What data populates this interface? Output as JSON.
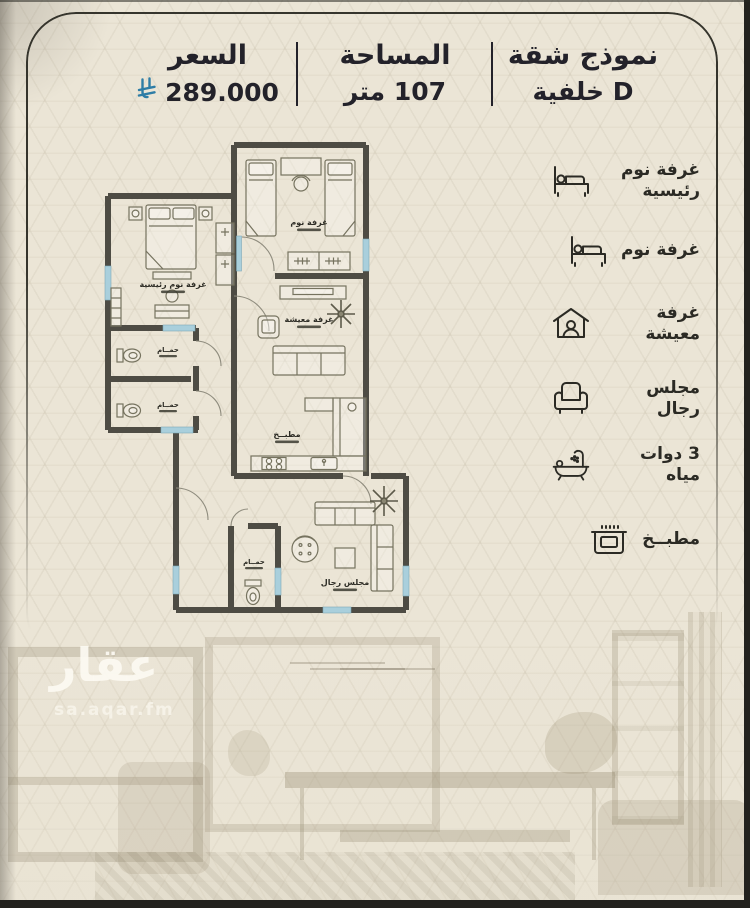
{
  "header": {
    "model": {
      "title": "نموذج شقة",
      "subtitle": "D خلفية"
    },
    "area": {
      "title": "المساحة",
      "value": "107 متر"
    },
    "price": {
      "title": "السعر",
      "value": "289.000",
      "currency_icon": "saudi-riyal-symbol"
    }
  },
  "legend": {
    "items": [
      {
        "icon": "master-bed-icon",
        "label": "غرفة نوم رئيسية"
      },
      {
        "icon": "bed-icon",
        "label": "غرفة نوم"
      },
      {
        "icon": "living-room-icon",
        "label": "غرفة معيشة"
      },
      {
        "icon": "armchair-icon",
        "label": "مجلس رجال"
      },
      {
        "icon": "bathtub-icon",
        "label": "3 دوات مياه"
      },
      {
        "icon": "stove-icon",
        "label": "مطبــخ"
      }
    ]
  },
  "floor_plan": {
    "rooms": {
      "master_bedroom": "غرفة نوم رئيسية",
      "bedroom": "غرفة نوم",
      "living_room": "غرفة معيشة",
      "kitchen": "مطبــخ",
      "majlis": "مجلس رجال",
      "bathroom": "حمــام"
    }
  },
  "watermark": {
    "logo": "عقار",
    "site": "sa.aqar.fm"
  },
  "colors": {
    "background": "#ebe5d6",
    "wall": "#4e4c44",
    "window_blue": "#a9cfdc",
    "text_dark": "#23222a",
    "riyal_blue": "#2e7da6"
  }
}
